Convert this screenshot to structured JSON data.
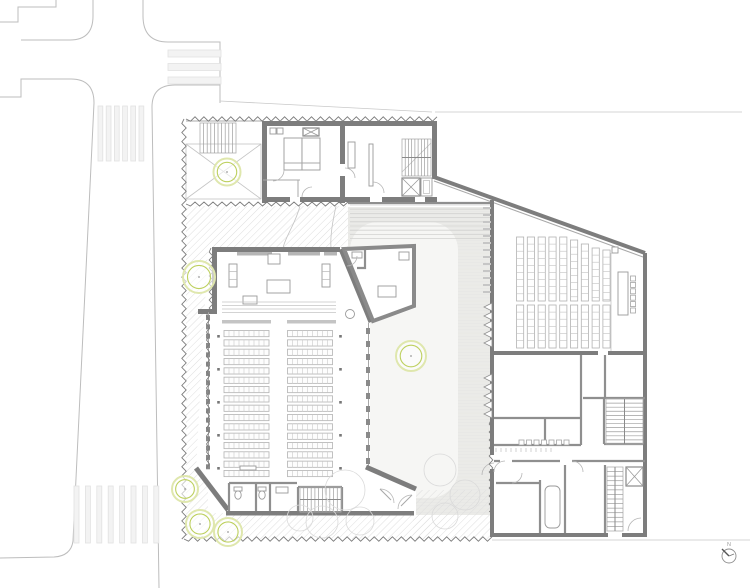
{
  "title": "Church floor plan — ground level site drawing",
  "north_arrow": {
    "label": "N"
  },
  "colors": {
    "paper": "#ffffff",
    "wall_dark": "#7d7d7d",
    "wall_mid": "#8f8f8f",
    "line_light": "#c4c4c4",
    "street_line": "#bdbdbd",
    "plaza_fill": "#ebebe8",
    "plaza_blob": "#f6f6f4",
    "hatch_line": "#dedede",
    "crosswalk_fill": "#f3f3f3",
    "tree_green": "#bdd05e",
    "tree_green_light": "#dfe7ad",
    "seat_stroke": "#b2b2b2"
  },
  "plan": {
    "crosswalks": [
      {
        "x0": 168,
        "y0": 50,
        "dx": 0,
        "dy": 13.5,
        "w": 53,
        "h": 7,
        "n": 3
      },
      {
        "x0": 98,
        "y0": 106,
        "dx": 8.2,
        "dy": 0,
        "w": 4.8,
        "h": 55,
        "n": 6
      },
      {
        "x0": 74,
        "y0": 486,
        "dx": 11.4,
        "dy": 0,
        "w": 5,
        "h": 57,
        "n": 8
      }
    ],
    "zigzags": [
      {
        "x1": 186,
        "y1": 119,
        "x2": 437,
        "y2": 119,
        "amp": 2.2,
        "per": 4.5
      },
      {
        "x1": 184,
        "y1": 119,
        "x2": 184,
        "y2": 539,
        "amp": 2.2,
        "per": 4.5
      },
      {
        "x1": 184,
        "y1": 539,
        "x2": 492,
        "y2": 539,
        "amp": 2.2,
        "per": 4.5
      },
      {
        "x1": 186,
        "y1": 204,
        "x2": 348,
        "y2": 204,
        "amp": 2,
        "per": 4.5
      },
      {
        "x1": 211,
        "y1": 248,
        "x2": 211,
        "y2": 312,
        "amp": 1.8,
        "per": 4
      },
      {
        "x1": 208,
        "y1": 312,
        "x2": 208,
        "y2": 468,
        "amp": 1.5,
        "per": 4
      },
      {
        "x1": 491,
        "y1": 420,
        "x2": 491,
        "y2": 512,
        "amp": 1.8,
        "per": 4
      }
    ],
    "stairs": [
      {
        "x": 200,
        "y": 123,
        "w": 36,
        "h": 30,
        "n": 10,
        "dir": "v",
        "mid": false
      },
      {
        "x": 402,
        "y": 139,
        "w": 29,
        "h": 37,
        "n": 9,
        "dir": "v",
        "mid": true
      },
      {
        "x": 300,
        "y": 487,
        "w": 41,
        "h": 25,
        "n": 11,
        "dir": "v",
        "mid": true
      },
      {
        "x": 606,
        "y": 399,
        "w": 37,
        "h": 45,
        "n": 11,
        "dir": "h",
        "mid": true
      },
      {
        "x": 607,
        "y": 467,
        "w": 16,
        "h": 64,
        "n": 14,
        "dir": "h",
        "mid": true
      }
    ],
    "pew_blocks": [
      {
        "x": 224,
        "w": 45,
        "y0": 330.5,
        "pitch": 9.33,
        "rows": 16,
        "h": 6.2,
        "cells": 9
      },
      {
        "x": 287.5,
        "w": 45,
        "y0": 330.5,
        "pitch": 9.33,
        "rows": 16,
        "h": 6.2,
        "cells": 9
      }
    ],
    "seat_blocks": [
      {
        "x0": 516.5,
        "dx": 10.8,
        "w": 7.2,
        "cell": 7.1,
        "tops": [
          237,
          237,
          237,
          237,
          237,
          240,
          244,
          248,
          250
        ],
        "bottom": 301
      },
      {
        "x0": 516.5,
        "dx": 10.8,
        "w": 7.2,
        "cell": 7.1,
        "tops": [
          305,
          305,
          305,
          305,
          305,
          305,
          305,
          305,
          305
        ],
        "bottom": 348
      }
    ],
    "trees": [
      {
        "cx": 227,
        "cy": 172,
        "r": 13.5
      },
      {
        "cx": 199,
        "cy": 277,
        "r": 16
      },
      {
        "cx": 411,
        "cy": 356,
        "r": 15
      },
      {
        "cx": 185,
        "cy": 489,
        "r": 13
      },
      {
        "cx": 200,
        "cy": 524,
        "r": 14
      },
      {
        "cx": 228,
        "cy": 532,
        "r": 14
      }
    ],
    "aisle_dots": {
      "xs": [
        218.5,
        340.5
      ],
      "y0": 335,
      "pitch": 33,
      "n": 5,
      "s": 2.6
    },
    "wall_dashes": [
      {
        "x": 206,
        "y0": 315,
        "pitch": 9.33,
        "n": 17,
        "w": 4,
        "h": 5
      },
      {
        "x": 366,
        "y0": 328,
        "pitch": 13,
        "n": 11,
        "w": 4,
        "h": 6
      }
    ],
    "louver_bars": {
      "x": 483,
      "y0": 207,
      "pitch": 7,
      "n": 13,
      "w": 8,
      "h": 2
    },
    "louver_triangles": [
      {
        "x": 484,
        "y0": 303,
        "pitch": 9,
        "n": 5,
        "s": 8
      },
      {
        "x": 484,
        "y0": 374,
        "pitch": 9,
        "n": 5,
        "s": 8
      }
    ],
    "step_lines": {
      "x0": 350,
      "x1": 490,
      "y0": 205,
      "pitch": 4.2,
      "n": 9
    },
    "counter_squares": {
      "x0": 519,
      "y": 440,
      "pitch": 7.5,
      "n": 7,
      "s": 5
    },
    "tick_row": {
      "x0": 496,
      "y": 448,
      "pitch": 5,
      "n": 12,
      "h": 4
    },
    "hall_chairs": {
      "x": 630.5,
      "y0": 276,
      "pitch": 6.4,
      "n": 6,
      "s": 5
    },
    "bench_cells": [
      {
        "x": 229,
        "y": 264,
        "w": 8,
        "h": 23,
        "cells": 3
      },
      {
        "x": 322,
        "y": 264,
        "w": 8,
        "h": 23,
        "cells": 3
      }
    ],
    "chancel_steps": {
      "x0": 222,
      "x1": 336,
      "ys": [
        302,
        305.5,
        309,
        312.5
      ]
    },
    "petals": [
      {
        "cx": 345,
        "cy": 490,
        "r": 20
      },
      {
        "cx": 322,
        "cy": 522,
        "r": 16
      },
      {
        "cx": 300,
        "cy": 518,
        "r": 13
      },
      {
        "cx": 360,
        "cy": 521,
        "r": 14
      },
      {
        "cx": 440,
        "cy": 470,
        "r": 16
      },
      {
        "cx": 465,
        "cy": 495,
        "r": 15
      },
      {
        "cx": 445,
        "cy": 516,
        "r": 13
      }
    ],
    "elevators": [
      {
        "x": 402,
        "y": 178,
        "w": 18,
        "h": 18
      },
      {
        "x": 626,
        "y": 467,
        "w": 17,
        "h": 19
      },
      {
        "x": 303,
        "y": 128,
        "w": 16,
        "h": 8
      }
    ]
  }
}
